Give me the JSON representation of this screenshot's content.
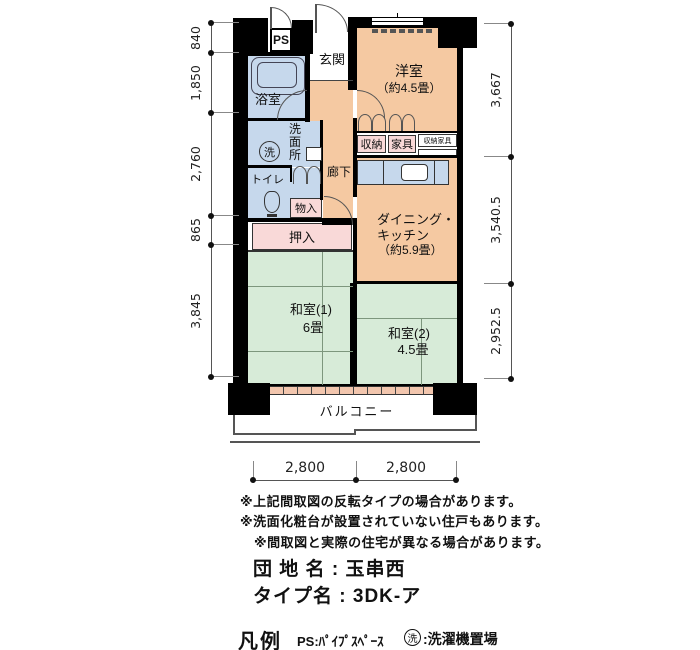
{
  "colors": {
    "wall": "#000000",
    "room_orange": "#f5c9a2",
    "room_blue": "#c6d8ec",
    "room_green": "#d7ebd8",
    "closet_pink": "#f9d9d8"
  },
  "plan": {
    "ps_label": "PS",
    "genkan": "玄関",
    "yoshitsu": {
      "name": "洋室",
      "size": "（約4.5畳）"
    },
    "yokushitsu": "浴室",
    "senmenjo": "洗面所",
    "laundry_symbol": "洗",
    "toire": "トイレ",
    "monoire": "物入",
    "oshiire": "押入",
    "rouka": "廊下",
    "shuno": "収納",
    "kagu": "家具",
    "shuno_kagu": "収納家具",
    "dk": {
      "line1": "ダイニング・",
      "line2": "キッチン",
      "line3": "（約5.9畳）"
    },
    "washitsu1": {
      "name": "和室(1)",
      "size": "6畳"
    },
    "washitsu2": {
      "name": "和室(2)",
      "size": "4.5畳"
    },
    "balcony": "バルコニー"
  },
  "dimensions": {
    "left": [
      "840",
      "1,850",
      "2,760",
      "865",
      "3,845"
    ],
    "right": [
      "3,667",
      "3,540.5",
      "2,952.5"
    ],
    "bottom": [
      "2,800",
      "2,800"
    ]
  },
  "notes": [
    "※上記間取図の反転タイプの場合があります。",
    "※洗面化粧台が設置されていない住戸もあります。",
    "※間取図と実際の住宅が異なる場合があります。"
  ],
  "property": {
    "danchi": "団 地 名 : 玉串西",
    "type": "タイプ名 : 3DK-ア"
  },
  "legend": {
    "title": "凡例",
    "ps": "PS:ﾊﾟｲﾌﾟｽﾍﾟｰｽ",
    "laundry_symbol": "洗",
    "laundry_desc": ":洗濯機置場"
  }
}
